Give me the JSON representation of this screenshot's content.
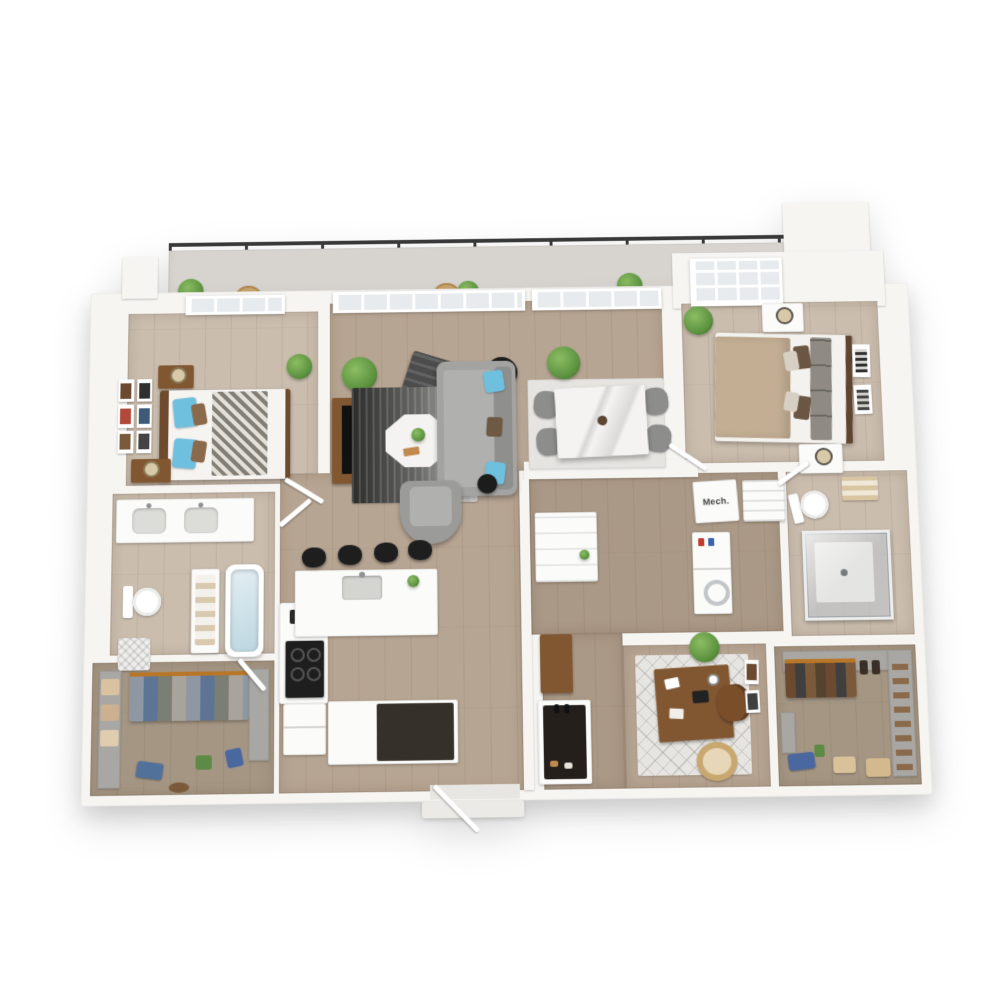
{
  "labels": {
    "mech_room": "Mech."
  },
  "palette": {
    "wall": "#f6f5f2",
    "glass": "#e7ebee",
    "floor_main": "#b7a593",
    "floor_light": "#cabdae",
    "floor_hall": "#ab9987",
    "floor_closet": "#a59684",
    "balcony_deck": "#d7d4d0",
    "railing": "#383838",
    "sofa": "#a3a3a1",
    "accent_blue": "#6fc0df",
    "rug_light": "#e6e4e0",
    "marble": "#f4f3f1",
    "wood_furniture": "#815732",
    "dark_appliance": "#1e1e1e",
    "appliance_white": "#fbfbfa",
    "bed_tan": "#c3ae93",
    "plant": "#5d9340",
    "hanger_orange": "#b87628",
    "denim": "#51719b",
    "label_text": "#3f3f3f"
  },
  "scene": {
    "type": "3d-apartment-floor-plan-render",
    "rooms": [
      {
        "name": "balcony",
        "items": [
          "railing",
          "bistro-table-1",
          "bistro-table-2",
          "potted-plants"
        ]
      },
      {
        "name": "bedroom-1",
        "items": [
          "bed-blue-pillows",
          "chevron-blanket",
          "nightstands",
          "gallery-wall",
          "window"
        ]
      },
      {
        "name": "living-room",
        "items": [
          "sofa",
          "coffee-table",
          "area-rug",
          "tv-console",
          "bench",
          "armchair",
          "floor-lamp",
          "palm-plant",
          "glass-wall"
        ]
      },
      {
        "name": "dining-area",
        "items": [
          "marble-table",
          "four-chairs",
          "area-rug",
          "palm-plant"
        ]
      },
      {
        "name": "kitchen",
        "items": [
          "island-with-sink",
          "four-bar-stools",
          "range",
          "counters",
          "refrigerator",
          "dark-cabinet"
        ]
      },
      {
        "name": "bedroom-2",
        "items": [
          "tan-bed",
          "nightstands",
          "wall-art",
          "plant",
          "skylight-window"
        ]
      },
      {
        "name": "mech-room",
        "items": [
          "mech-unit"
        ]
      },
      {
        "name": "linen-closet",
        "items": [
          "shelves"
        ]
      },
      {
        "name": "laundry-closet",
        "items": [
          "stacked-washer-dryer"
        ]
      },
      {
        "name": "bathroom-1",
        "items": [
          "double-vanity",
          "toilet",
          "bathtub",
          "hamper",
          "linen-shelf"
        ]
      },
      {
        "name": "bathroom-2",
        "items": [
          "toilet",
          "glass-shower",
          "towel-shelf"
        ]
      },
      {
        "name": "office",
        "items": [
          "desk",
          "chair",
          "diamond-rug",
          "plant",
          "wall-frames",
          "basket"
        ]
      },
      {
        "name": "walk-in-closet-1",
        "items": [
          "hanging-clothes",
          "folded-linens",
          "floor-items"
        ]
      },
      {
        "name": "walk-in-closet-2",
        "items": [
          "hanging-clothes",
          "shoe-shelves",
          "baskets",
          "bag"
        ]
      },
      {
        "name": "entry",
        "items": [
          "front-door",
          "step",
          "coat-closet",
          "console",
          "pantry"
        ]
      }
    ]
  }
}
